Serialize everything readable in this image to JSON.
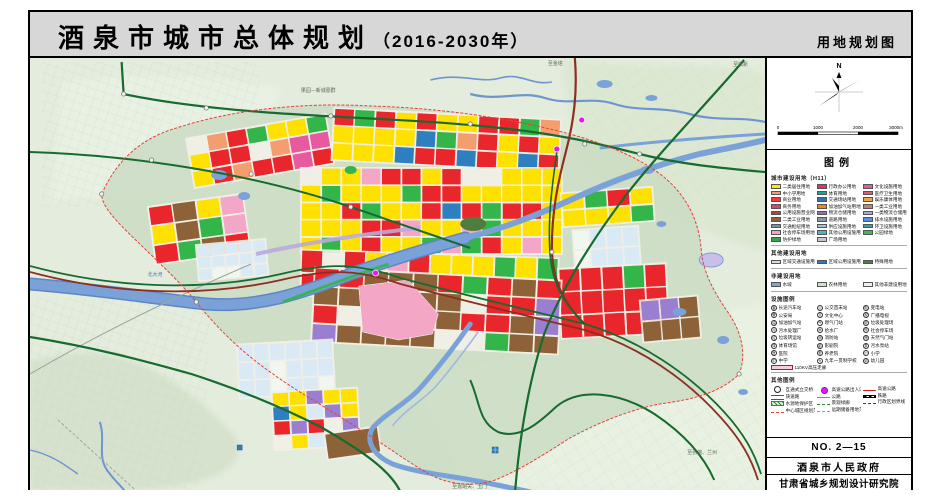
{
  "title": {
    "main": "酒泉市城市总体规划",
    "year": "（2016-2030年）",
    "subtitle": "用地规划图"
  },
  "panel": {
    "compass_n": "N",
    "scale_ticks": [
      "0",
      "1000",
      "2000",
      "3000m"
    ],
    "legend_title": "图例",
    "sections": {
      "landuse": {
        "title": "城市建设用地（H11）",
        "col1": [
          {
            "c": "#FFE800",
            "l": "二类居住用地"
          },
          {
            "c": "#F49E70",
            "l": "中小学用地"
          },
          {
            "c": "#FF3333",
            "l": "商业用地"
          },
          {
            "c": "#E0426B",
            "l": "商务用地"
          },
          {
            "c": "#A94A3F",
            "l": "公用设施营业网点用地"
          },
          {
            "c": "#8D6239",
            "l": "二类工业用地"
          },
          {
            "c": "#6F93A8",
            "l": "交通枢纽用地"
          },
          {
            "c": "#F3A6C6",
            "l": "社会停车场用地"
          },
          {
            "c": "#33A448",
            "l": "防护绿地"
          }
        ],
        "col2": [
          {
            "c": "#E72D6E",
            "l": "行政办公用地"
          },
          {
            "c": "#14A79B",
            "l": "体育用地"
          },
          {
            "c": "#3D6EB4",
            "l": "交通场站用地"
          },
          {
            "c": "#F08519",
            "l": "加油加气站用地"
          },
          {
            "c": "#8F6FBF",
            "l": "物流仓储用地"
          },
          {
            "c": "#8A98A5",
            "l": "道路用地"
          },
          {
            "c": "#9CC6E8",
            "l": "供应设施用地"
          },
          {
            "c": "#3BBBD2",
            "l": "其他公用设施用地"
          },
          {
            "c": "#C9C9C9",
            "l": "广场用地"
          }
        ],
        "col3": [
          {
            "c": "#E857A0",
            "l": "文化设施用地"
          },
          {
            "c": "#E85A74",
            "l": "医疗卫生用地"
          },
          {
            "c": "#F0A241",
            "l": "娱乐康体用地"
          },
          {
            "c": "#BC8A60",
            "l": "一类工业用地"
          },
          {
            "c": "#B7A3DC",
            "l": "一类物流仓储用地"
          },
          {
            "c": "#5B8FD6",
            "l": "排水设施用地"
          },
          {
            "c": "#2FA6A3",
            "l": "环卫设施用地"
          },
          {
            "c": "#3DBB4E",
            "l": "公园绿地"
          }
        ]
      },
      "other": {
        "title": "其他建设用地",
        "items": [
          {
            "c": "#D9D9D9",
            "l": "区域交通设施用地"
          },
          {
            "c": "#1F7FC4",
            "l": "区域公用设施用地"
          },
          {
            "c": "#4E7E3E",
            "l": "特殊用地"
          }
        ]
      },
      "noncon": {
        "title": "非建设用地",
        "items": [
          {
            "c": "#7FA5D8",
            "l": "水域"
          },
          {
            "c": "#CDE4C2",
            "l": "农林用地"
          },
          {
            "c": "#EAF4E6",
            "l": "其他非建设用地"
          }
        ]
      },
      "facilities": {
        "title": "设施图例",
        "col1": [
          {
            "g": "客",
            "l": "长途汽车站"
          },
          {
            "g": "警",
            "l": "公安局"
          },
          {
            "g": "油",
            "l": "加油加气站"
          },
          {
            "g": "污",
            "l": "污水处理厂"
          },
          {
            "g": "垃",
            "l": "垃圾转运站"
          },
          {
            "g": "体",
            "l": "体育场馆"
          },
          {
            "g": "医",
            "l": "医院"
          },
          {
            "g": "中",
            "l": "中学"
          }
        ],
        "col2": [
          {
            "g": "公",
            "l": "公交首末站"
          },
          {
            "g": "文",
            "l": "文化中心"
          },
          {
            "g": "气",
            "l": "燃气门站"
          },
          {
            "g": "水",
            "l": "给水厂"
          },
          {
            "g": "消",
            "l": "消防站"
          },
          {
            "g": "影",
            "l": "影剧院"
          },
          {
            "g": "老",
            "l": "养老院"
          },
          {
            "g": "九",
            "l": "九年一贯制学校"
          }
        ],
        "col3": [
          {
            "g": "电",
            "l": "变电站"
          },
          {
            "g": "视",
            "l": "广播电视"
          },
          {
            "g": "圾",
            "l": "垃圾处理场"
          },
          {
            "g": "停",
            "l": "社会停车场"
          },
          {
            "g": "燃",
            "l": "天然气门站"
          },
          {
            "g": "泵",
            "l": "污水泵站"
          },
          {
            "g": "小",
            "l": "小学"
          },
          {
            "g": "幼",
            "l": "幼儿园"
          }
        ],
        "hv": {
          "c": "#F6CEDC",
          "l": "110KV高压走廊"
        }
      },
      "lines": {
        "title": "其他图例",
        "col1": [
          {
            "t": "interchange",
            "l": "互通式立交桥"
          },
          {
            "t": "expwy",
            "l": "快速路"
          },
          {
            "t": "hatchg",
            "l": "水源地保护区"
          },
          {
            "t": "dashred",
            "l": "中心城区规划范围"
          }
        ],
        "col2": [
          {
            "t": "dotmag",
            "l": "高速公路出入口"
          },
          {
            "t": "gray",
            "l": "公路"
          },
          {
            "t": "dashg",
            "l": "景观绿廊"
          },
          {
            "t": "dashgray",
            "l": "远期储备用地范围"
          }
        ],
        "col3": [
          {
            "t": "red",
            "l": "高速公路"
          },
          {
            "t": "rail",
            "l": "铁路"
          },
          {
            "t": "dashdot",
            "l": "行政区划界线"
          }
        ]
      }
    },
    "footer": {
      "no": "NO. 2—15",
      "gov": "酒泉市人民政府",
      "institute": "甘肃省城乡规划设计研究院"
    }
  },
  "map": {
    "labels": [
      {
        "text": "果园—新城墓群"
      },
      {
        "text": "至金塔"
      },
      {
        "text": "至鼎新"
      },
      {
        "text": "北大河"
      },
      {
        "text": "至嘉峪关、玉门"
      },
      {
        "text": "至张掖、兰州"
      }
    ],
    "palette": {
      "yellow": "#FFE100",
      "red": "#E8262B",
      "salmon": "#F49E70",
      "green": "#33B54A",
      "blue": "#2E7FC0",
      "magenta": "#E85AA0",
      "pink": "#F3A6C6",
      "brown": "#8D6239",
      "purple": "#9A7FD0",
      "ltblue": "#D9EAF5",
      "paper": "#F2F6F0",
      "gray": "#BFC7C0",
      "orange": "#F08519"
    },
    "colors": {
      "water": "#7BA2D8",
      "water_edge": "#5E86C4",
      "road_green": "#176B2F",
      "road_red": "#8B2F20",
      "boundary": "#E8403A",
      "node_magenta": "#E619E6"
    }
  }
}
